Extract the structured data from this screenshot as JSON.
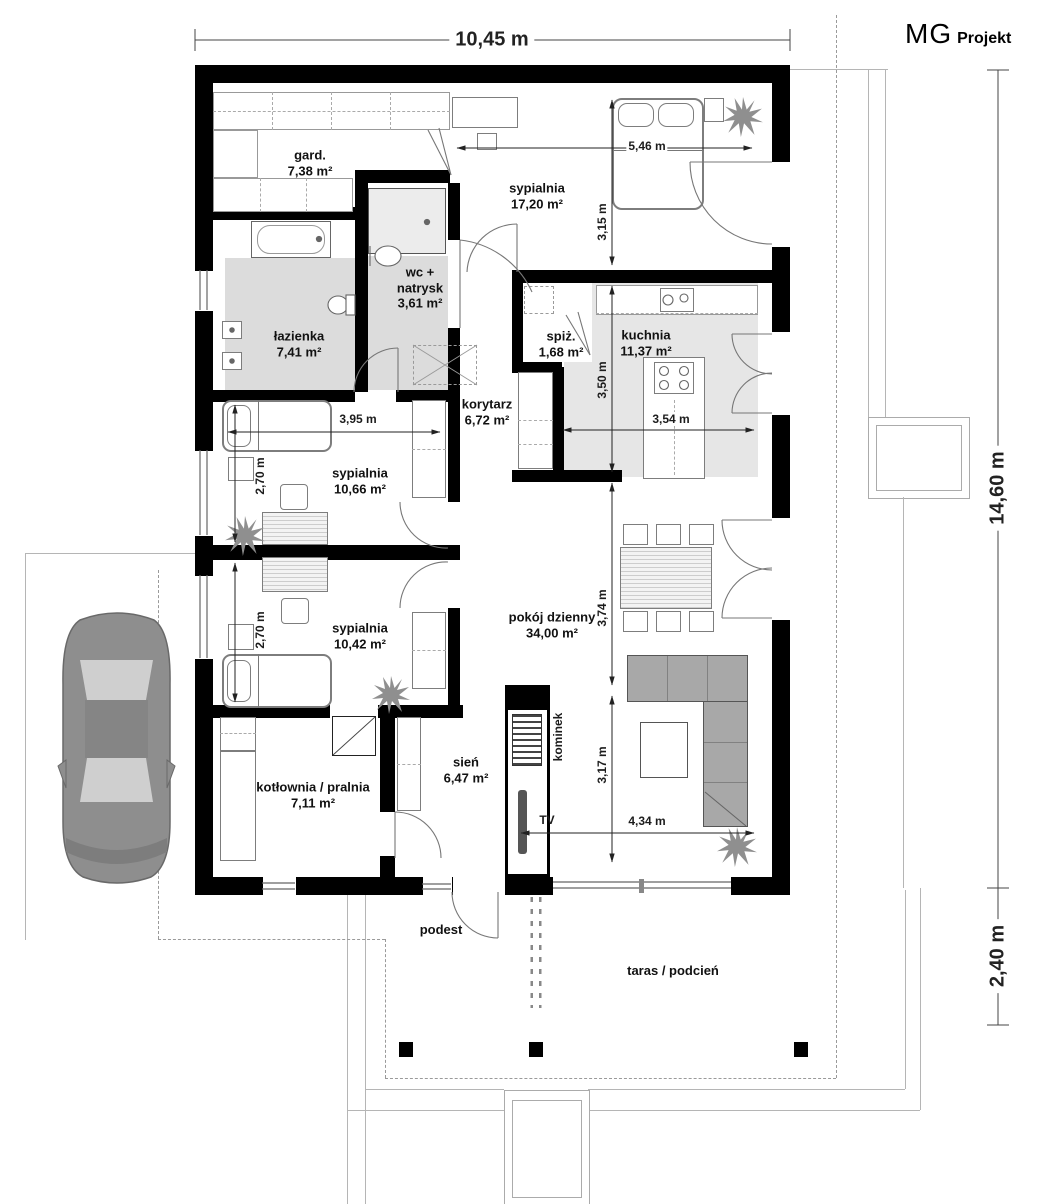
{
  "brand": {
    "name_light": "MG",
    "name_bold": "Projekt"
  },
  "plan": {
    "width_label": "10,45 m",
    "height_label": "14,60 m",
    "terrace_depth_label": "2,40 m"
  },
  "rooms": {
    "gard": {
      "name": "gard.",
      "area": "7,38 m²"
    },
    "sypialnia1": {
      "name": "sypialnia",
      "area": "17,20 m²"
    },
    "wc": {
      "name_line1": "wc +",
      "name_line2": "natrysk",
      "area": "3,61 m²"
    },
    "lazienka": {
      "name": "łazienka",
      "area": "7,41 m²"
    },
    "spiz": {
      "name": "spiż.",
      "area": "1,68 m²"
    },
    "kuchnia": {
      "name": "kuchnia",
      "area": "11,37 m²"
    },
    "korytarz": {
      "name": "korytarz",
      "area": "6,72 m²"
    },
    "sypialnia2": {
      "name": "sypialnia",
      "area": "10,66 m²"
    },
    "sypialnia3": {
      "name": "sypialnia",
      "area": "10,42 m²"
    },
    "pokoj": {
      "name": "pokój dzienny",
      "area": "34,00 m²"
    },
    "kotlownia": {
      "name": "kotłownia / pralnia",
      "area": "7,11 m²"
    },
    "sien": {
      "name": "sień",
      "area": "6,47 m²"
    }
  },
  "dims": {
    "bed1_width": "5,46 m",
    "bed1_height": "3,15 m",
    "kitchen_height": "3,50 m",
    "kitchen_width": "3,54 m",
    "bed2_width": "3,95 m",
    "bed2_height": "2,70 m",
    "bed3_height": "2,70 m",
    "dining_height": "3,74 m",
    "living_height": "3,17 m",
    "living_width": "4,34 m"
  },
  "annotations": {
    "fireplace": "kominek",
    "tv": "TV",
    "podest": "podest",
    "terrace": "taras / podcień"
  },
  "colors": {
    "wall": "#000000",
    "floor_gray": "#dcdcdc",
    "sofa": "#a8a8a8",
    "car": "#8e8e8e"
  }
}
